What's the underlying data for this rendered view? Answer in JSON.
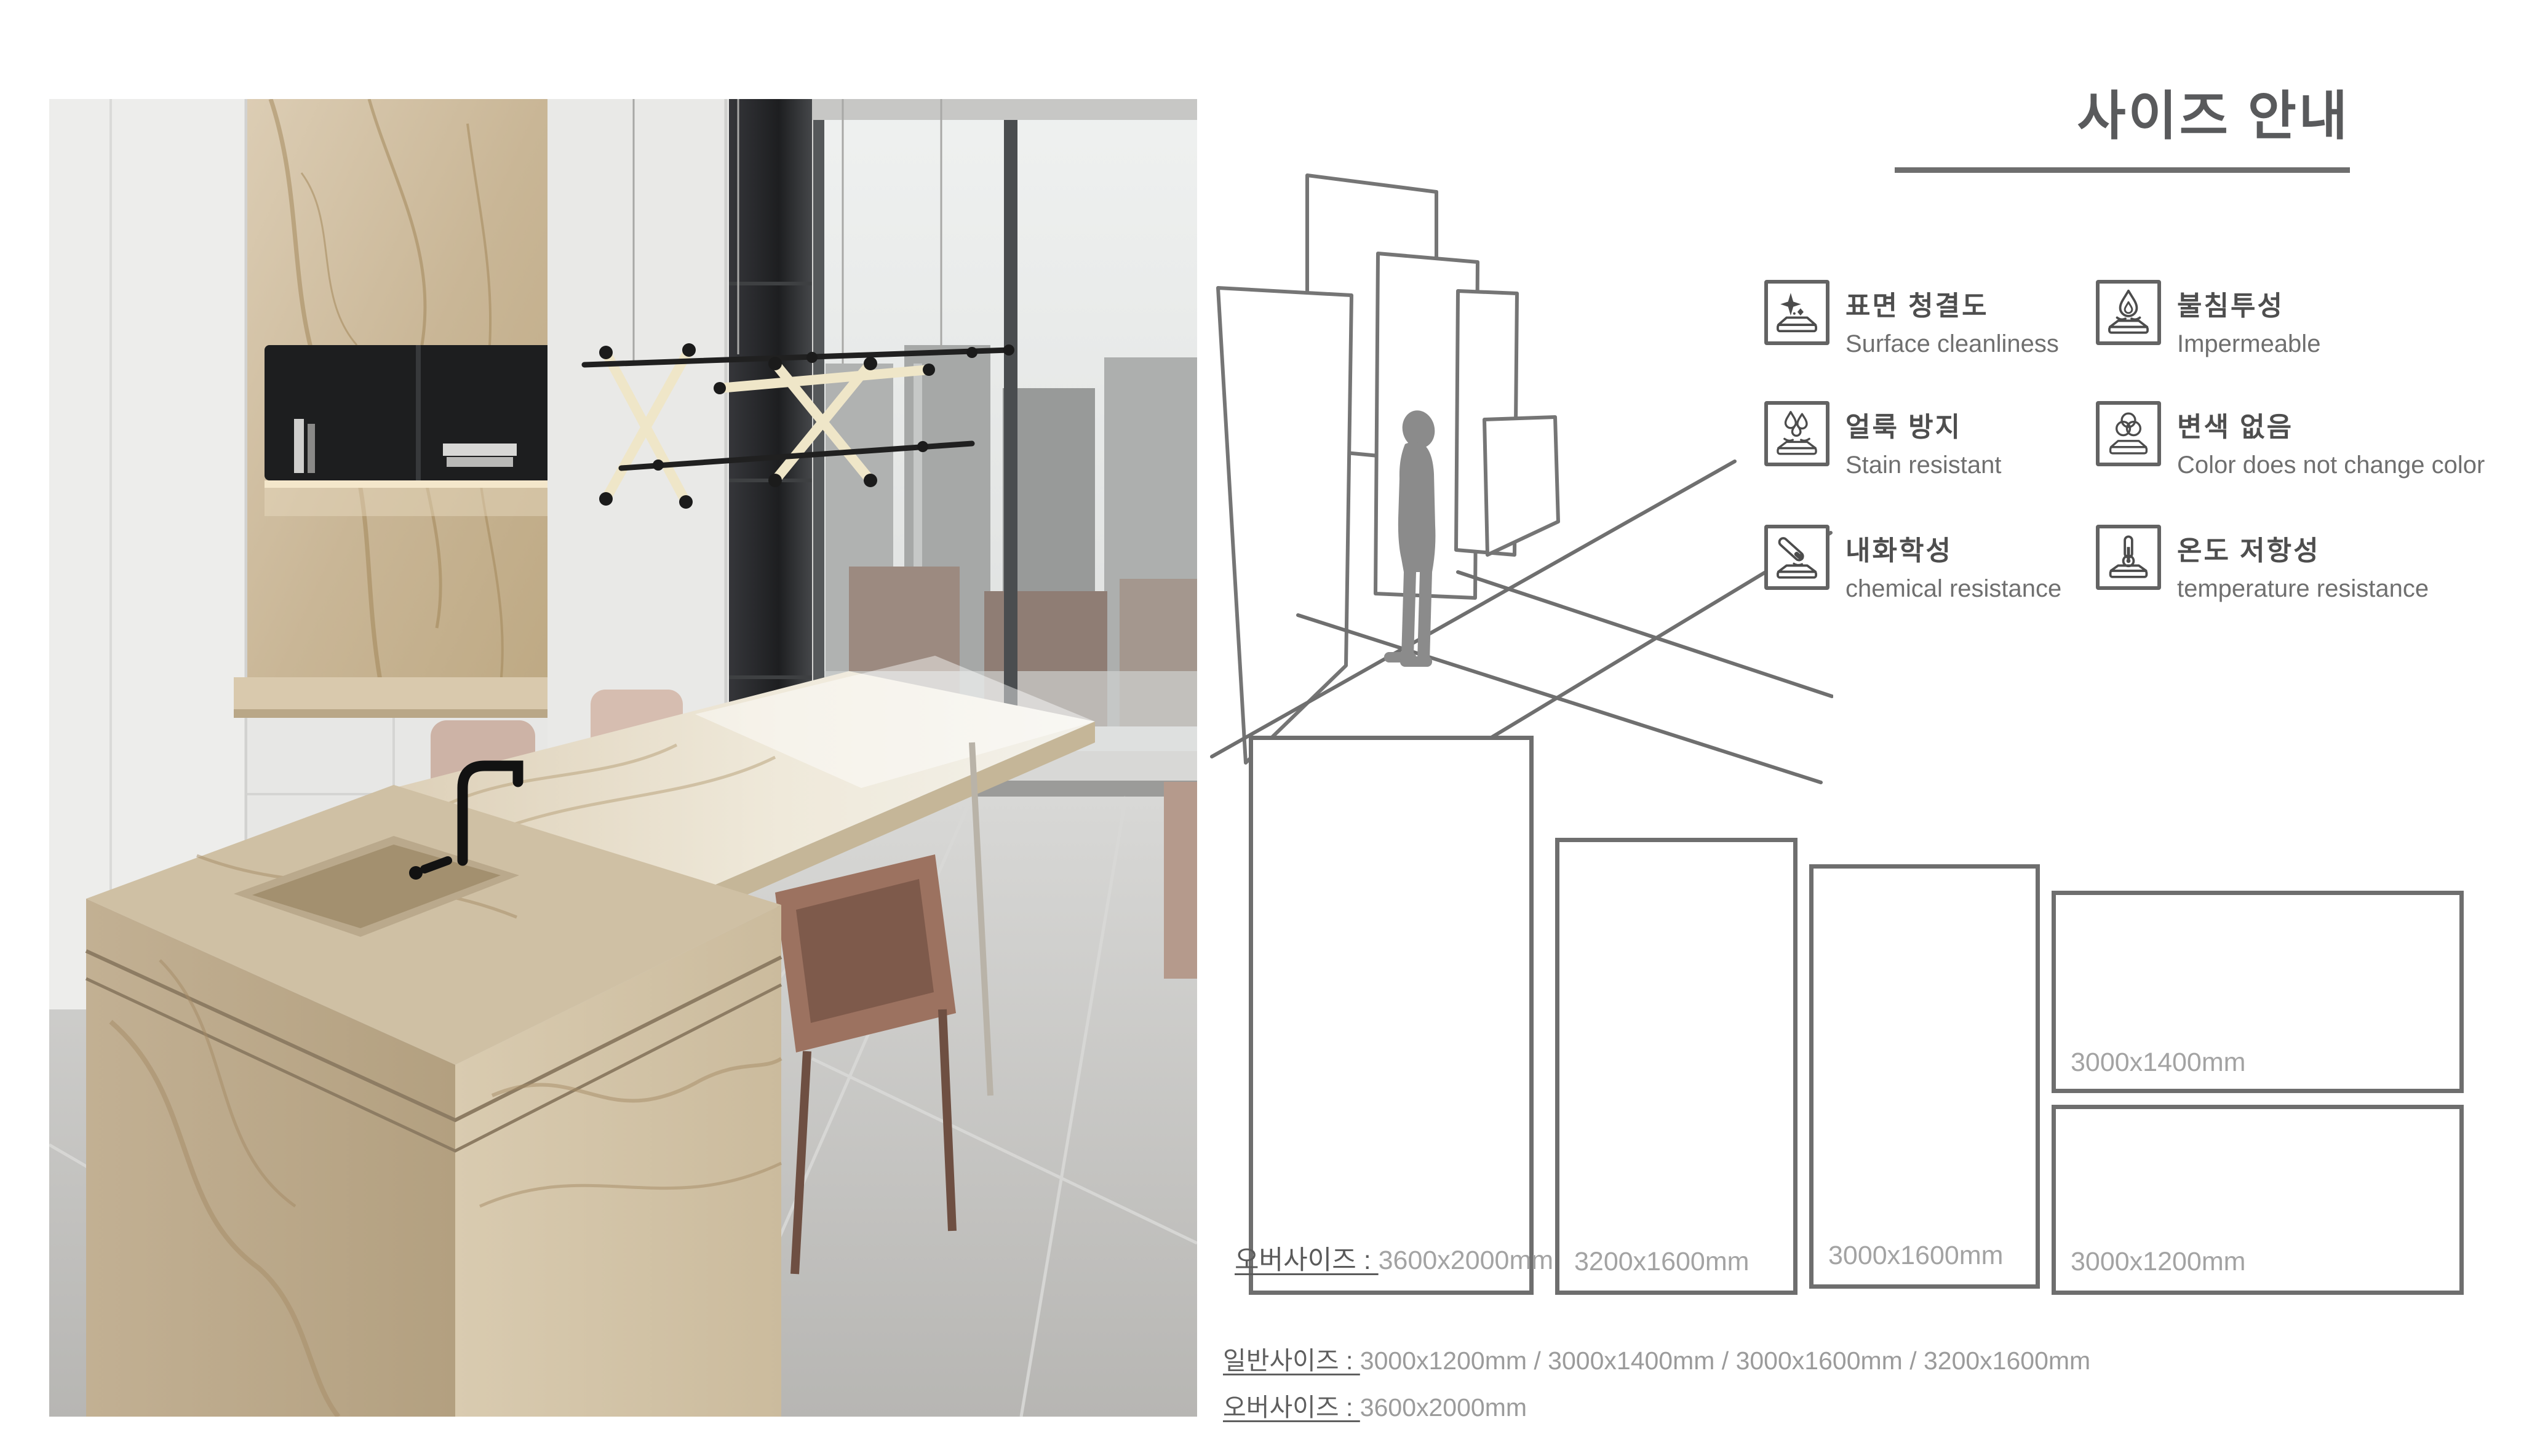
{
  "page": {
    "title": "사이즈 안내"
  },
  "features": [
    {
      "icon": "sparkle-slab-icon",
      "ko": "표면 청결도",
      "en": "Surface cleanliness"
    },
    {
      "icon": "droplet-slab-icon",
      "ko": "불침투성",
      "en": "Impermeable"
    },
    {
      "icon": "droplets-slab-icon",
      "ko": "얼룩 방지",
      "en": "Stain resistant"
    },
    {
      "icon": "color-circles-slab-icon",
      "ko": "변색 없음",
      "en": "Color does not change color"
    },
    {
      "icon": "test-tube-slab-icon",
      "ko": "내화학성",
      "en": "chemical resistance"
    },
    {
      "icon": "thermometer-slab-icon",
      "ko": "온도 저항성",
      "en": "temperature resistance"
    }
  ],
  "size_diagram": {
    "slabs": [
      {
        "prefix": "오버사이즈 : ",
        "size": "3600x2000mm"
      },
      {
        "prefix": "",
        "size": "3200x1600mm"
      },
      {
        "prefix": "",
        "size": "3000x1600mm"
      },
      {
        "prefix": "",
        "size": "3000x1400mm"
      },
      {
        "prefix": "",
        "size": "3000x1200mm"
      }
    ]
  },
  "summary": {
    "lines": [
      {
        "label": "일반사이즈 : ",
        "value": "3000x1200mm / 3000x1400mm / 3000x1600mm / 3200x1600mm"
      },
      {
        "label": "오버사이즈 : ",
        "value": "3600x2000mm"
      }
    ]
  },
  "colors": {
    "title_gray": "#595a5c",
    "rect_border_gray": "#6e6e6e",
    "label_dark_gray": "#5a5a5a",
    "value_light_gray": "#a3a3a3",
    "silhouette_gray": "#8b8b8b",
    "marble_beige": "#cdbc9f",
    "marble_vein": "#a08455"
  }
}
